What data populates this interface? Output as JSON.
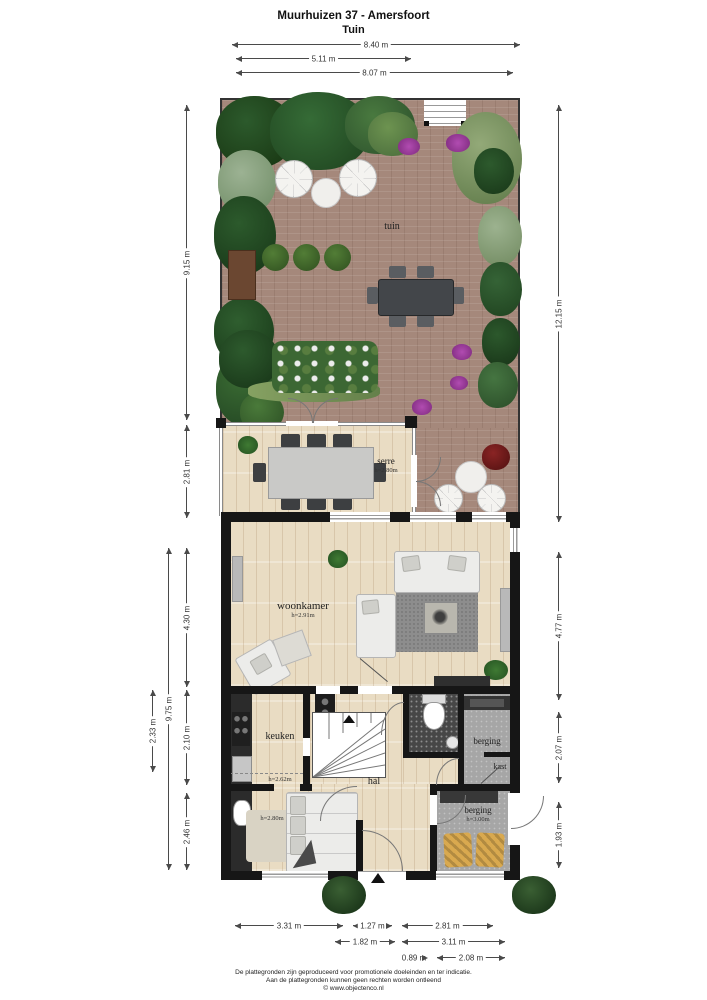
{
  "title": {
    "line1": "Muurhuizen 37 - Amersfoort",
    "line2": "Tuin"
  },
  "rooms": {
    "tuin": {
      "name": "tuin"
    },
    "serre": {
      "name": "serre",
      "height": "h=2.80m"
    },
    "woonkamer": {
      "name": "woonkamer",
      "height": "h=2.91m"
    },
    "keuken": {
      "name": "keuken",
      "height": "h=2.62m"
    },
    "hal": {
      "name": "hal"
    },
    "berging_boven": {
      "name": "berging"
    },
    "kast": {
      "name": "kast"
    },
    "berging_onder": {
      "name": "berging",
      "height": "h=3.00m"
    },
    "kamer": {
      "height": "h=2.80m"
    }
  },
  "dims": {
    "top": [
      "8.40 m",
      "5.11 m",
      "8.07 m"
    ],
    "left": [
      "9.15 m",
      "2.81 m",
      "9.75 m",
      "2.33 m",
      "4.30 m",
      "2.10 m",
      "2.46 m"
    ],
    "right": [
      "12.15 m",
      "4.77 m",
      "2.07 m",
      "1.93 m"
    ],
    "bottom": [
      "3.31 m",
      "1.27 m",
      "2.81 m",
      "1.82 m",
      "3.11 m",
      "0.89 m",
      "2.08 m"
    ]
  },
  "footer": {
    "line1": "De plattegronden zijn geproduceerd voor promotionele doeleinden en ter indicatie.",
    "line2": "Aan de plattegronden kunnen geen rechten worden ontleend",
    "line3": "© www.objectenco.nl"
  },
  "colors": {
    "brick": "#a5887b",
    "wood": "#e9dcc3",
    "wall": "#161616",
    "gray_floor": "#a6a6a6",
    "flower_purple": "#b14cb1",
    "chair_tan": "#d9a94f"
  }
}
